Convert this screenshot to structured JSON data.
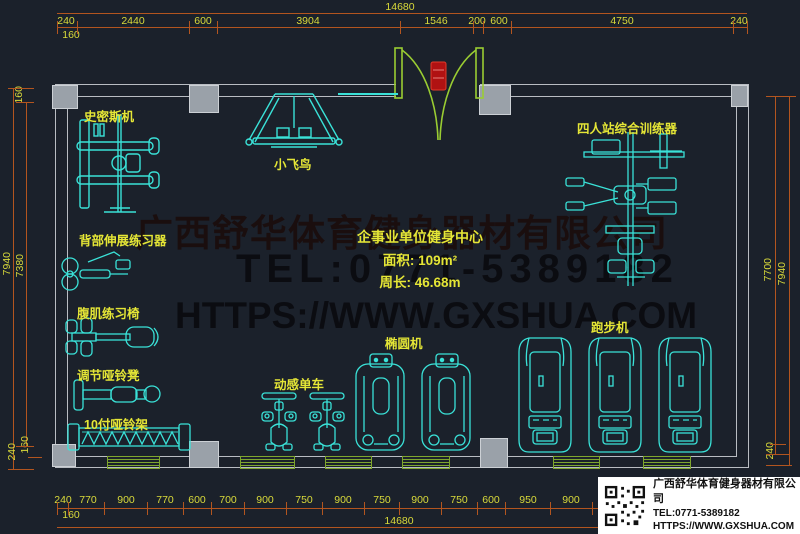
{
  "drawing": {
    "room": {
      "name": "企事业单位健身中心",
      "area": "面积: 109m²",
      "perimeter": "周长: 46.68m"
    },
    "equipment_labels": {
      "smith": "史密斯机",
      "fly_bird": "小飞鸟",
      "four_station": "四人站综合训练器",
      "back_extension": "背部伸展练习器",
      "ab_chair": "腹肌练习椅",
      "adj_dumbbell_bench": "调节哑铃凳",
      "dumbbell_rack": "10付哑铃架",
      "spin_bike": "动感单车",
      "elliptical": "椭圆机",
      "treadmill": "跑步机"
    },
    "dimensions": {
      "top": {
        "overall": "14680",
        "offset": "160",
        "segments": [
          "240",
          "2440",
          "600",
          "3904",
          "1546",
          "200",
          "600",
          "4750",
          "240"
        ]
      },
      "bottom": {
        "overall": "14680",
        "offset": "160",
        "segments": [
          "240",
          "770",
          "900",
          "770",
          "600",
          "700",
          "900",
          "750",
          "900",
          "750",
          "900",
          "750",
          "600",
          "950",
          "900"
        ]
      },
      "left": {
        "overall": "7940",
        "inner": "7380",
        "top_offset": "160",
        "bottom_wall": "240",
        "bottom_offset": "160"
      },
      "right": {
        "inner": "7700",
        "overall": "7940",
        "bottom_wall": "240"
      }
    },
    "watermark": {
      "line1": "广西舒华体育健身器材有限公司",
      "line2": "TEL:0771-5389182",
      "line3": "HTTPS://WWW.GXSHUA.COM"
    }
  },
  "info_box": {
    "company": "广西舒华体育健身器材有限公司",
    "tel": "TEL:0771-5389182",
    "url": "HTTPS://WWW.GXSHUA.COM",
    "qr": "qr-code"
  },
  "colors": {
    "background": "#1b212b",
    "equipment": "#3ae2d8",
    "label_yellow": "#e5e636",
    "dim_line_orange": "#b3551f",
    "dim_text": "#d9da3a",
    "wall_gray": "#b9bdc3",
    "column_fill": "#9aa1a9",
    "door_green": "#9acd32",
    "door_red": "#b01212",
    "window_green": "#7fa62e",
    "watermark_dark": "#0b0b10"
  }
}
